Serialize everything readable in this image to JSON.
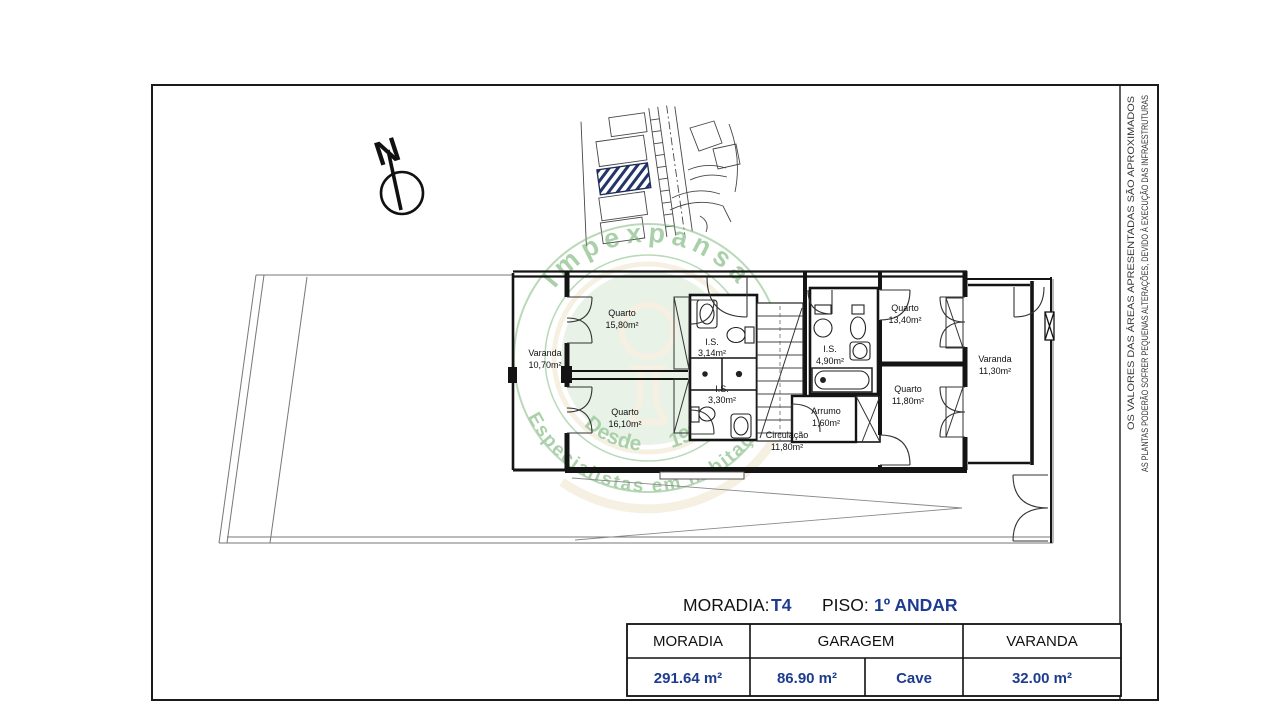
{
  "page": {
    "north_label": "N"
  },
  "colors": {
    "accent_navy": "#1d3c8f",
    "watermark_green": "#6fae6f",
    "watermark_disc": "#d5e8d2",
    "watermark_cream": "#ece4c8",
    "hatch_blue": "#24356b",
    "line_black": "#141414"
  },
  "watermark": {
    "brand": "Impexpansa",
    "tagline": "Especialistas em habitação",
    "since": "Desde 1992"
  },
  "rooms": [
    {
      "name": "Varanda",
      "area": "10,70m²"
    },
    {
      "name": "Quarto",
      "area": "15,80m²"
    },
    {
      "name": "Quarto",
      "area": "16,10m²"
    },
    {
      "name": "I.S.",
      "area": "3,14m²"
    },
    {
      "name": "I.S.",
      "area": "3,30m²"
    },
    {
      "name": "Circulação",
      "area": "11,80m²"
    },
    {
      "name": "I.S.",
      "area": "4,90m²"
    },
    {
      "name": "Arrumo",
      "area": "1,60m²"
    },
    {
      "name": "Quarto",
      "area": "13,40m²"
    },
    {
      "name": "Quarto",
      "area": "11,80m²"
    },
    {
      "name": "Varanda",
      "area": "11,30m²"
    }
  ],
  "title": {
    "moradia_label": "MORADIA:",
    "moradia_value": "T4",
    "piso_label": "PISO:",
    "piso_value": "1º ANDAR"
  },
  "table": {
    "headers": [
      "MORADIA",
      "GARAGEM",
      "VARANDA"
    ],
    "values": [
      "291.64 m²",
      "86.90 m²",
      "Cave",
      "32.00 m²"
    ]
  },
  "disclaimers": {
    "line1": "OS VALORES DAS ÁREAS APRESENTADAS SÃO APROXIMADOS",
    "line2": "AS PLANTAS PODERÃO SOFRER PEQUENAS ALTERAÇÕES, DEVIDO À EXECUÇÃO DAS INFRAESTRUTURAS"
  }
}
